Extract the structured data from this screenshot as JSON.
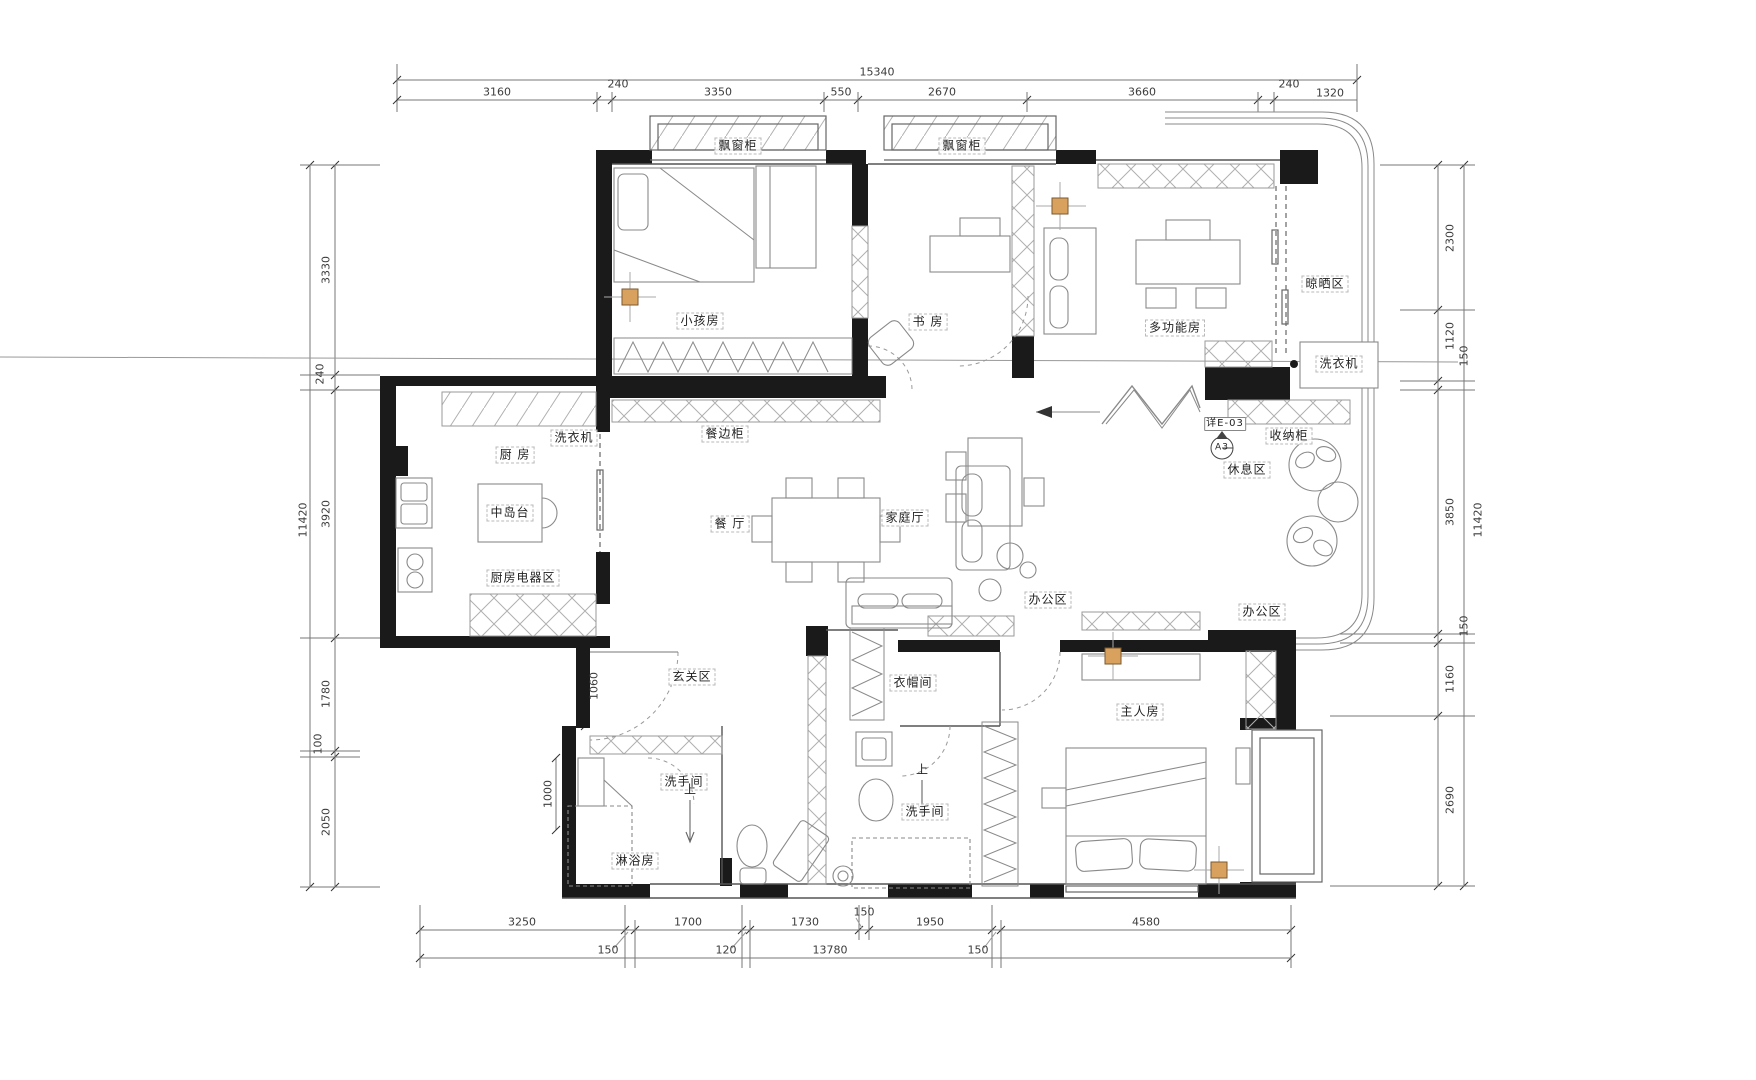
{
  "drawing": {
    "type": "residential-floor-plan",
    "units": "mm"
  },
  "colors": {
    "wall": "#1a1a1a",
    "line": "#8a8a8a",
    "hatch": "#b0b0b0",
    "dim": "#3c3c3c",
    "column_fill": "#d9a15e",
    "background": "#ffffff"
  },
  "labels": {
    "bay_cabinet_left": "飘窗柜",
    "bay_cabinet_right": "飘窗柜",
    "kids_room": "小孩房",
    "study": "书 房",
    "multi_room": "多功能房",
    "drying_area": "晾晒区",
    "washer_balcony": "洗衣机",
    "storage_cabinet": "收纳柜",
    "rest_area": "休息区",
    "washer_kitchen": "洗衣机",
    "kitchen": "厨 房",
    "island": "中岛台",
    "kitchen_appliance": "厨房电器区",
    "sideboard": "餐边柜",
    "dining": "餐 厅",
    "family_hall": "家庭厅",
    "office_center": "办公区",
    "office_right": "办公区",
    "entry": "玄关区",
    "cloakroom": "衣帽间",
    "master_room": "主人房",
    "bath_left": "洗手间",
    "bath_right": "洗手间",
    "shower_room": "淋浴房",
    "up_left": "上",
    "up_right": "上",
    "detail_ref": "详E-03",
    "detail_tag": "A3"
  },
  "dims": {
    "top": {
      "total": "15340",
      "segments": [
        "3160",
        "240",
        "3350",
        "550",
        "2670",
        "3660",
        "240",
        "1320"
      ]
    },
    "left": {
      "total": "11420",
      "segments": [
        "3330",
        "240",
        "3920",
        "1780",
        "100",
        "2050"
      ]
    },
    "right": {
      "total": "11420",
      "segments": [
        "2300",
        "1120",
        "150",
        "3850",
        "150",
        "1160",
        "2690"
      ]
    },
    "bottom": {
      "total": "13780",
      "segments": [
        "3250",
        "1700",
        "1730",
        "150",
        "1950",
        "4580"
      ],
      "offsets": [
        "150",
        "120",
        "150"
      ]
    },
    "inner": {
      "hall_width": "1060",
      "bath_width": "1000"
    }
  }
}
